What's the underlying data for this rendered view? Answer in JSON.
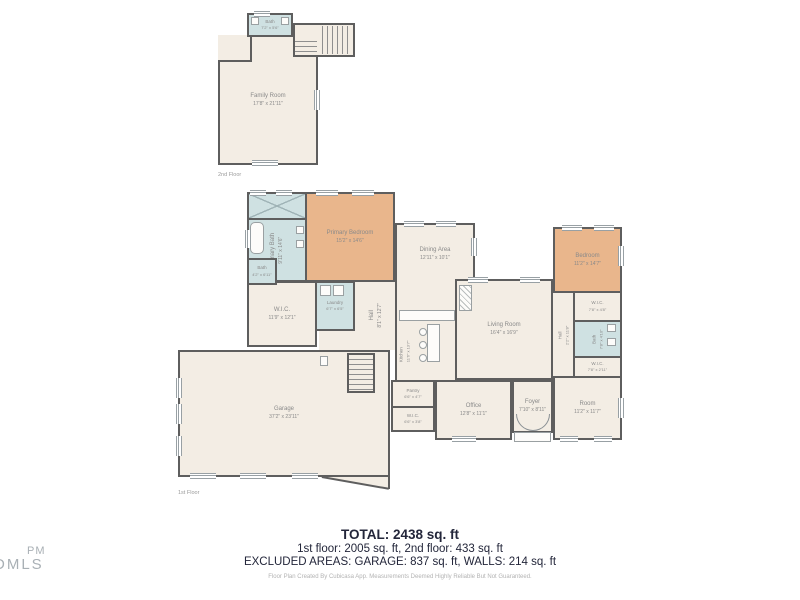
{
  "colors": {
    "wall": "#5e5e5e",
    "floor_fill": "#f3ede4",
    "bedroom_fill": "#e9b68c",
    "wet_room_fill": "#cfe1e2"
  },
  "floor2": {
    "caption": "2nd Floor",
    "rooms": {
      "family_room": {
        "name": "Family Room",
        "dims": "17'8\" x 21'11\""
      },
      "bath": {
        "name": "Bath",
        "dims": "7'2\" x 5'6\""
      }
    }
  },
  "floor1": {
    "caption": "1st Floor",
    "rooms": {
      "primary_bedroom": {
        "name": "Primary Bedroom",
        "dims": "15'2\" x 14'6\""
      },
      "primary_bath": {
        "name": "Primary Bath",
        "dims": "9'11\" x 14'6\""
      },
      "bath_left": {
        "name": "Bath",
        "dims": "4'2\" x 6'11\""
      },
      "wic_left": {
        "name": "W.I.C.",
        "dims": "11'9\" x 12'1\""
      },
      "laundry": {
        "name": "Laundry",
        "dims": "6'7\" x 6'5\""
      },
      "hall_center": {
        "name": "Hall",
        "dims": "8'1\" x 12'7\""
      },
      "kitchen": {
        "name": "Kitchen",
        "dims": "11'6\" x 13'7\""
      },
      "dining_area": {
        "name": "Dining Area",
        "dims": "12'11\" x 10'1\""
      },
      "living_room": {
        "name": "Living Room",
        "dims": "16'4\" x 16'9\""
      },
      "hall_right": {
        "name": "Hall",
        "dims": "2'2\" x 11'8\""
      },
      "bedroom": {
        "name": "Bedroom",
        "dims": "11'2\" x 14'7\""
      },
      "wic_right_upper": {
        "name": "W.I.C.",
        "dims": "7'8\" x 4'8\""
      },
      "bath_right": {
        "name": "Bath",
        "dims": "7'8\" x 4'10\""
      },
      "wic_right_lower": {
        "name": "W.I.C.",
        "dims": "7'8\" x 2'11\""
      },
      "room": {
        "name": "Room",
        "dims": "11'2\" x 11'7\""
      },
      "office": {
        "name": "Office",
        "dims": "12'8\" x 11'1\""
      },
      "pantry": {
        "name": "Pantry",
        "dims": "6'6\" x 4'7\""
      },
      "wic_small": {
        "name": "W.I.C.",
        "dims": "6'6\" x 3'8\""
      },
      "foyer": {
        "name": "Foyer",
        "dims": "7'10\" x 8'11\""
      },
      "garage": {
        "name": "Garage",
        "dims": "37'2\" x 23'11\""
      }
    }
  },
  "summary": {
    "total": "TOTAL: 2438 sq. ft",
    "floors_line": "1st floor: 2005 sq. ft, 2nd floor: 433 sq. ft",
    "excluded_line": "EXCLUDED AREAS: GARAGE: 837 sq. ft, WALLS: 214 sq. ft",
    "disclaimer": "Floor Plan Created By Cubicasa App. Measurements Deemed Highly Reliable But Not Guaranteed."
  },
  "watermark": {
    "line1": "PM",
    "line2": "DMLS"
  }
}
